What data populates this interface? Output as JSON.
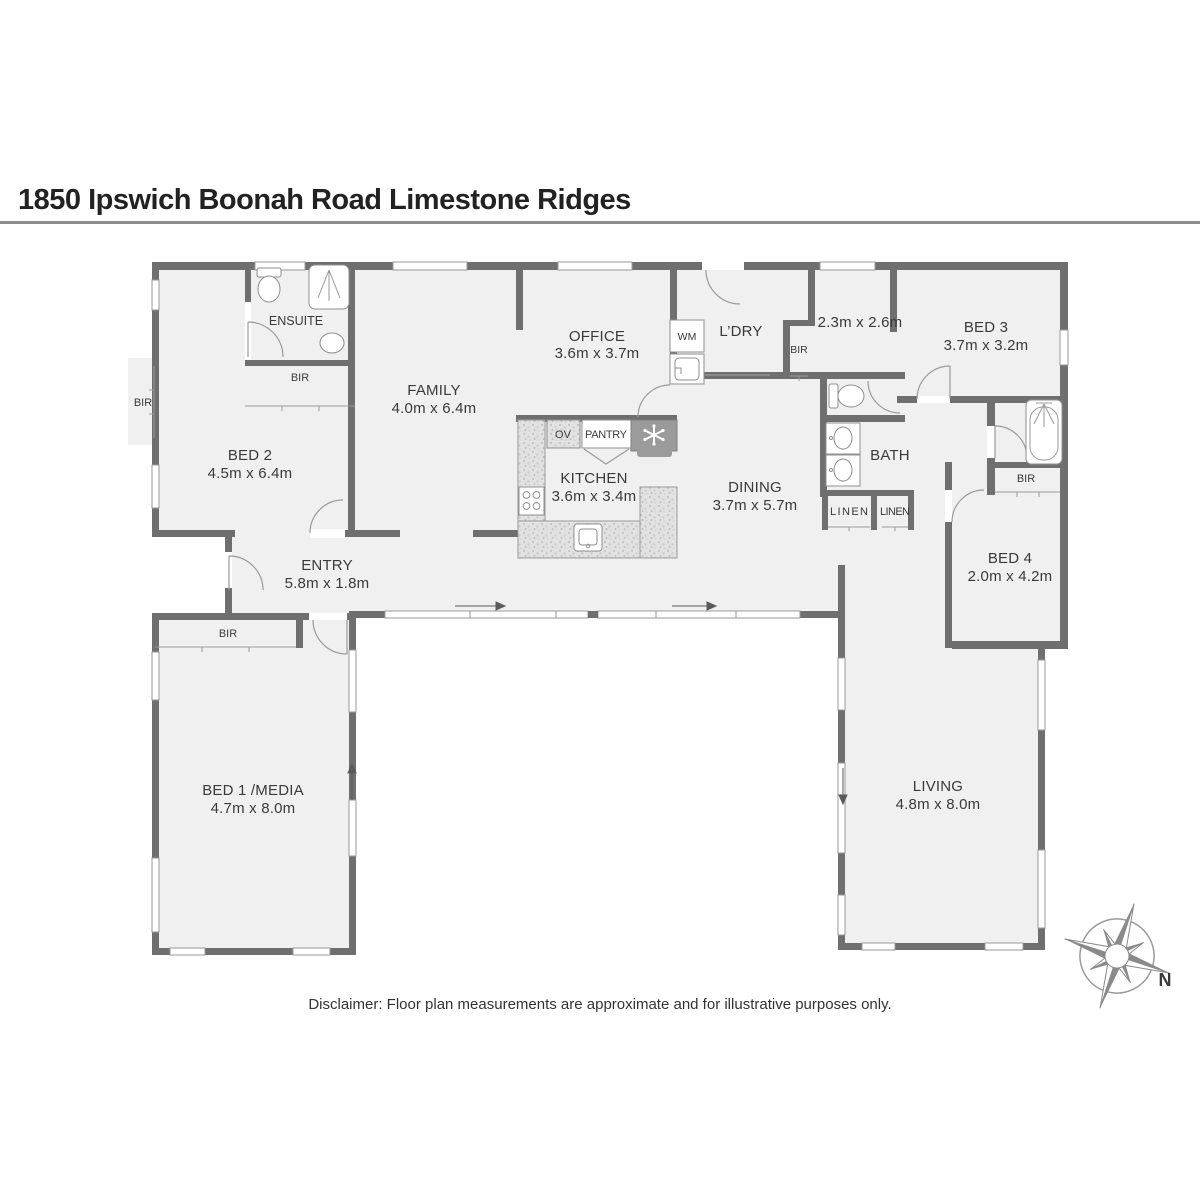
{
  "title": "1850 Ipswich Boonah Road Limestone Ridges",
  "disclaimer": "Disclaimer: Floor plan measurements are approximate and for illustrative purposes only.",
  "compass": {
    "north_label": "N"
  },
  "colors": {
    "wall": "#6f6f6f",
    "floor": "#f0f0f0",
    "window_stroke": "#9a9a9a",
    "fixture_stroke": "#8f8f8f",
    "text": "#3a3a3a",
    "rule": "#8c8c8c"
  },
  "rooms": {
    "ensuite": {
      "name": "ENSUITE"
    },
    "bir_ensuite": {
      "name": "BIR"
    },
    "bir_west": {
      "name": "BIR"
    },
    "bed2": {
      "name": "BED 2",
      "dims": "4.5m x 6.4m"
    },
    "family": {
      "name": "FAMILY",
      "dims": "4.0m x 6.4m"
    },
    "office": {
      "name": "OFFICE",
      "dims": "3.6m x 3.7m"
    },
    "wm": {
      "name": "WM"
    },
    "laundry": {
      "name": "L’DRY"
    },
    "bir_laundry": {
      "name": "BIR"
    },
    "store": {
      "dims": "2.3m x 2.6m"
    },
    "bed3": {
      "name": "BED 3",
      "dims": "3.7m x 3.2m"
    },
    "ov": {
      "name": "OV"
    },
    "pantry": {
      "name": "PANTRY"
    },
    "kitchen": {
      "name": "KITCHEN",
      "dims": "3.6m x 3.4m"
    },
    "dining": {
      "name": "DINING",
      "dims": "3.7m x 5.7m"
    },
    "bath": {
      "name": "BATH"
    },
    "linen1": {
      "name": "LINEN"
    },
    "linen2": {
      "name": "LINEN"
    },
    "bir_bed4": {
      "name": "BIR"
    },
    "bed4": {
      "name": "BED 4",
      "dims": "2.0m x 4.2m"
    },
    "entry": {
      "name": "ENTRY",
      "dims": "5.8m x 1.8m"
    },
    "bir_bed1": {
      "name": "BIR"
    },
    "bed1": {
      "name": "BED 1 /MEDIA",
      "dims": "4.7m x 8.0m"
    },
    "living": {
      "name": "LIVING",
      "dims": "4.8m x 8.0m"
    }
  }
}
